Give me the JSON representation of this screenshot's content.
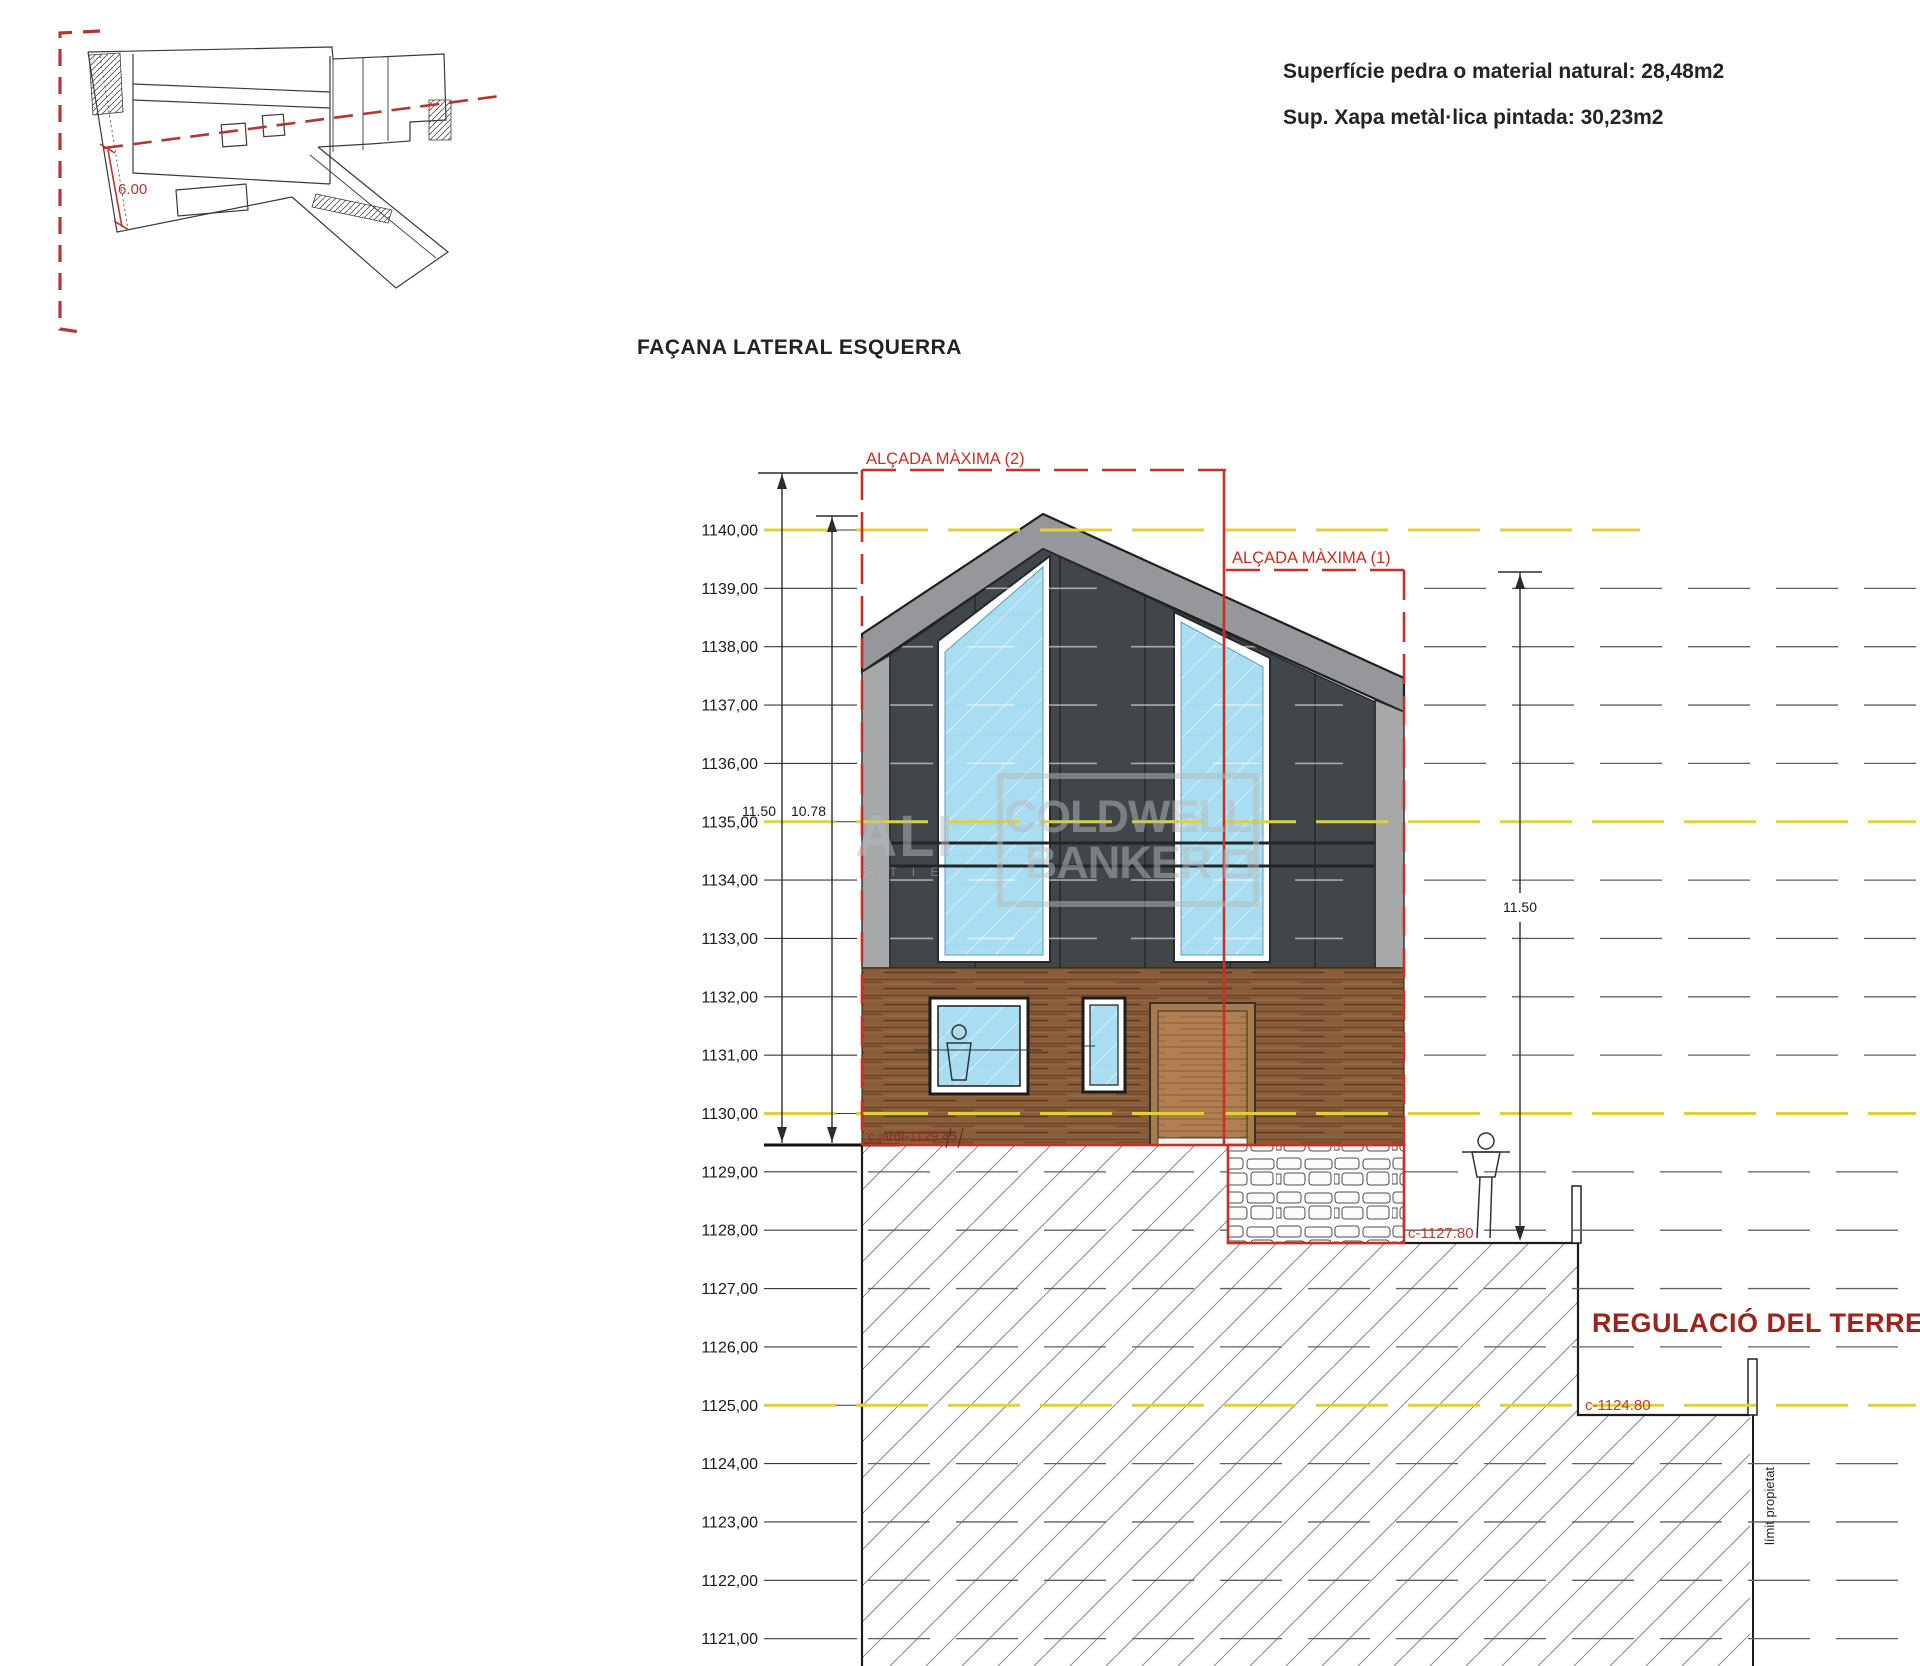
{
  "title": "FAÇANA LATERAL ESQUERRA",
  "notes": {
    "surface_stone": "Superfície pedra o material natural: 28,48m2",
    "surface_metal": "Sup. Xapa metàl·lica pintada: 30,23m2"
  },
  "plan": {
    "dimension": "6.00"
  },
  "elevation": {
    "levels": [
      {
        "label": "1140,00",
        "highlight": true
      },
      {
        "label": "1139,00",
        "highlight": false
      },
      {
        "label": "1138,00",
        "highlight": false
      },
      {
        "label": "1137,00",
        "highlight": false
      },
      {
        "label": "1136,00",
        "highlight": false
      },
      {
        "label": "1135,00",
        "highlight": true
      },
      {
        "label": "1134,00",
        "highlight": false
      },
      {
        "label": "1133,00",
        "highlight": false
      },
      {
        "label": "1132,00",
        "highlight": false
      },
      {
        "label": "1131,00",
        "highlight": false
      },
      {
        "label": "1130,00",
        "highlight": true
      },
      {
        "label": "1129,00",
        "highlight": false
      },
      {
        "label": "1128,00",
        "highlight": false
      },
      {
        "label": "1127,00",
        "highlight": false
      },
      {
        "label": "1126,00",
        "highlight": false
      },
      {
        "label": "1125,00",
        "highlight": true
      },
      {
        "label": "1124,00",
        "highlight": false
      },
      {
        "label": "1123,00",
        "highlight": false
      },
      {
        "label": "1122,00",
        "highlight": false
      },
      {
        "label": "1121,00",
        "highlight": false
      }
    ],
    "dimensions": {
      "outer_left": "11.50",
      "inner_left": "10.78",
      "right": "11.50"
    },
    "red_marks": {
      "alcada_maxima_2": "ALÇADA MÀXIMA (2)",
      "alcada_maxima_1": "ALÇADA MÀXIMA (1)",
      "garden_level": "c.jardí-1129.45",
      "level_1127": "c-1127.80",
      "level_1124": "c-1124.80",
      "terrain_regulation": "REGULACIÓ DEL TERRENY"
    },
    "property_limit": "límit propietat"
  },
  "watermark": {
    "line1": "COLDWELL",
    "line2": "BANKER",
    "left_big": "ALI",
    "left_small": "R T I E"
  },
  "colors": {
    "red_accent": "#c92f25",
    "maroon_text": "#8e2a23",
    "level_yellow": "#ddd23e",
    "glass_blue": "#a9def2",
    "wood_brown": "#8a5e3a",
    "wall_charcoal": "#41464a",
    "roof_gray": "#95979a"
  }
}
